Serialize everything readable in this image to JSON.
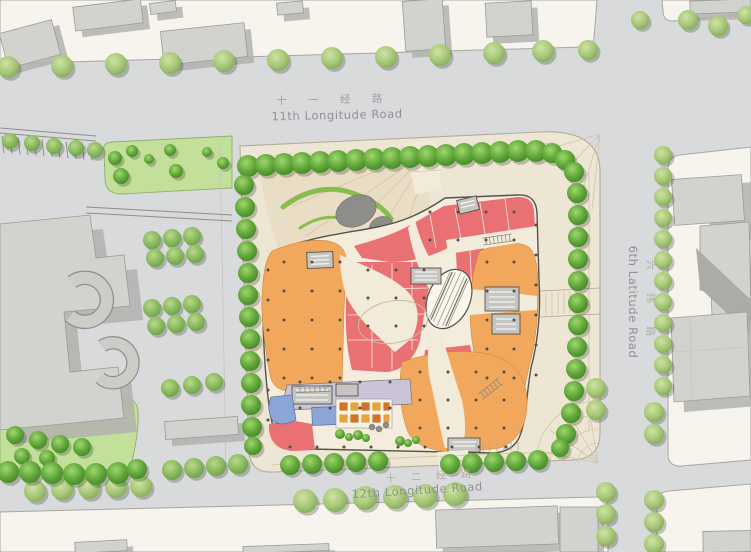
{
  "labels": {
    "road_north_zh": "十 一 经 路",
    "road_north_en": "11th Longitude Road",
    "road_south_zh": "十 二 经 路",
    "road_south_en": "12th Longitude Road",
    "road_east_zh": "六 纬 路",
    "road_east_en": "6th Latitude Road"
  },
  "palette": {
    "road": "#d8dadc",
    "block": "#f7f4ee",
    "site_paving": "#eee6d5",
    "plaza": "#e7dcc0",
    "corridor_cream": "#f3ebd9",
    "retail_red": "#e97173",
    "anchor_orange": "#f2a85c",
    "service_lavender": "#c9c4d8",
    "blue_unit": "#8ba6d6",
    "equipment_yellow": "#e8a33d",
    "equipment_orange": "#d4722a",
    "tree_street": "#9cc06d",
    "tree_site": "#57a134",
    "lawn": "#c3e09b",
    "existing_building": "#d2d2cf",
    "sculpture_gray": "#8d8d89",
    "label_text": "#8f9194"
  }
}
